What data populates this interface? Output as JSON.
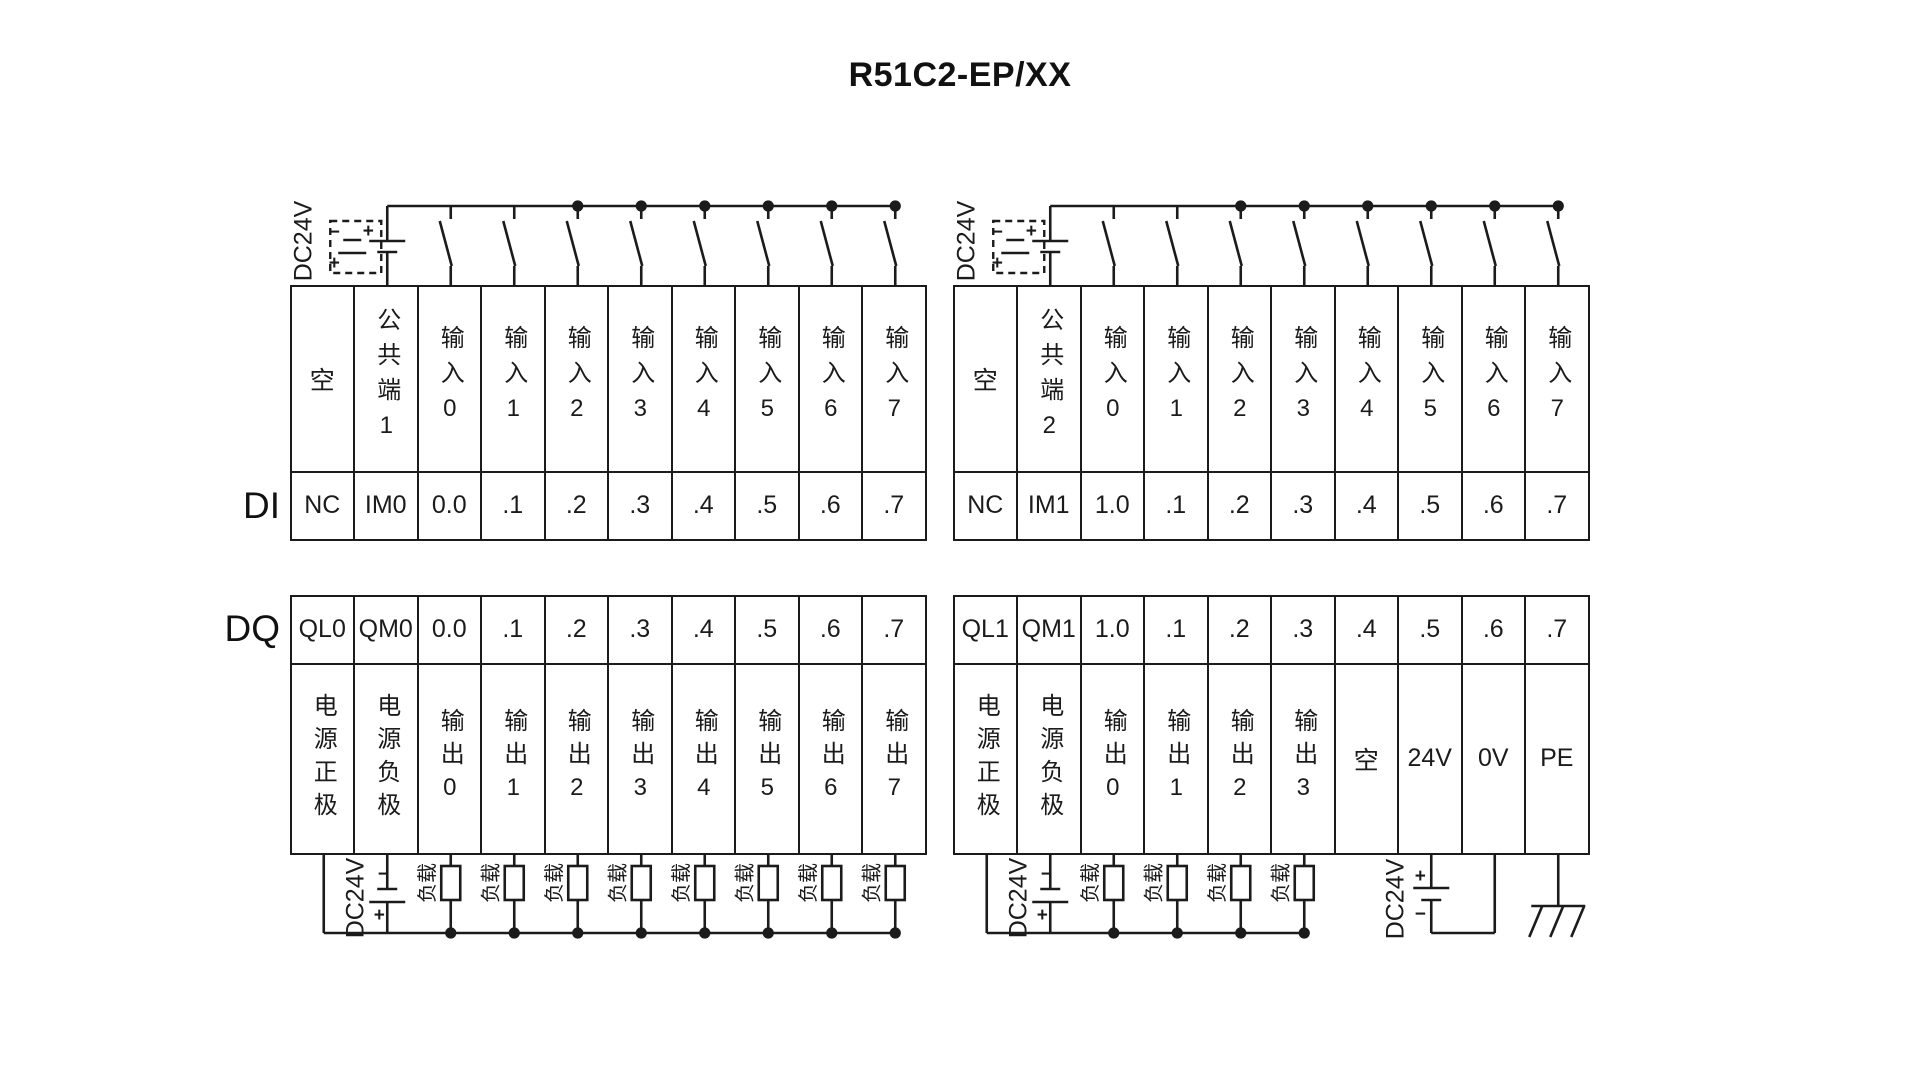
{
  "title": "R51C2-EP/XX",
  "section_labels": {
    "di": "DI",
    "dq": "DQ"
  },
  "di": {
    "left": {
      "headers": [
        "空",
        "公共端1",
        "输入0",
        "输入1",
        "输入2",
        "输入3",
        "输入4",
        "输入5",
        "输入6",
        "输入7"
      ],
      "terminals": [
        "NC",
        "IM0",
        "0.0",
        ".1",
        ".2",
        ".3",
        ".4",
        ".5",
        ".6",
        ".7"
      ]
    },
    "right": {
      "headers": [
        "空",
        "公共端2",
        "输入0",
        "输入1",
        "输入2",
        "输入3",
        "输入4",
        "输入5",
        "输入6",
        "输入7"
      ],
      "terminals": [
        "NC",
        "IM1",
        "1.0",
        ".1",
        ".2",
        ".3",
        ".4",
        ".5",
        ".6",
        ".7"
      ]
    }
  },
  "dq": {
    "left": {
      "terminals": [
        "QL0",
        "QM0",
        "0.0",
        ".1",
        ".2",
        ".3",
        ".4",
        ".5",
        ".6",
        ".7"
      ],
      "headers": [
        "电源正极",
        "电源负极",
        "输出0",
        "输出1",
        "输出2",
        "输出3",
        "输出4",
        "输出5",
        "输出6",
        "输出7"
      ]
    },
    "right": {
      "terminals": [
        "QL1",
        "QM1",
        "1.0",
        ".1",
        ".2",
        ".3",
        ".4",
        ".5",
        ".6",
        ".7"
      ],
      "headers": [
        "电源正极",
        "电源负极",
        "输出0",
        "输出1",
        "输出2",
        "输出3",
        "空",
        "24V",
        "0V",
        "PE"
      ]
    }
  },
  "wiring": {
    "power_label": "DC24V",
    "load_label": "负载",
    "plus": "+",
    "minus": "−"
  },
  "colors": {
    "line": "#1b1b1b",
    "text": "#111111",
    "background": "#ffffff"
  }
}
